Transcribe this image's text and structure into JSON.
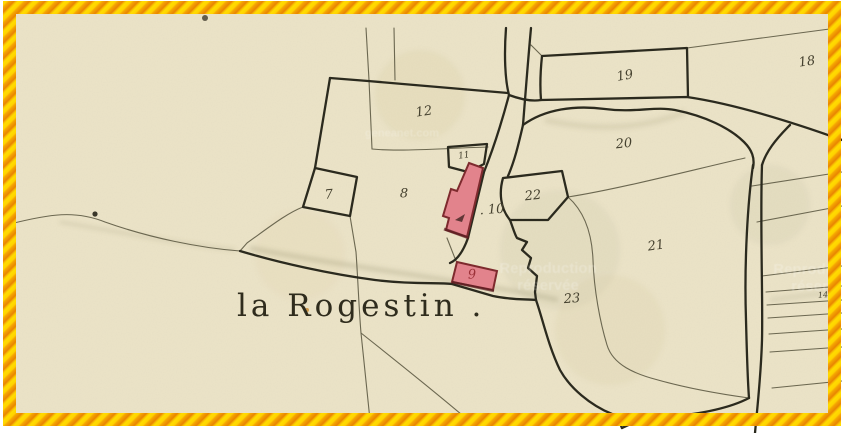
{
  "map": {
    "place_label": "la Rogestin .",
    "parcel_numbers": [
      {
        "id": "7",
        "text": "7",
        "x": 329,
        "y": 195,
        "rot": -5
      },
      {
        "id": "8",
        "text": "8",
        "x": 404,
        "y": 194,
        "rot": 0
      },
      {
        "id": "11",
        "text": "11",
        "x": 464,
        "y": 156,
        "size": 9,
        "rot": -8
      },
      {
        "id": "12",
        "text": "12",
        "x": 424,
        "y": 112,
        "rot": -8
      },
      {
        "id": "10",
        "text": ". 10",
        "x": 492,
        "y": 210,
        "rot": -4
      },
      {
        "id": "9",
        "text": "9",
        "x": 472,
        "y": 275,
        "color": "#9c3138",
        "rot": -2
      },
      {
        "id": "19",
        "text": "19",
        "x": 625,
        "y": 76,
        "rot": -10
      },
      {
        "id": "18",
        "text": "18",
        "x": 807,
        "y": 62,
        "rot": -8
      },
      {
        "id": "20",
        "text": "20",
        "x": 624,
        "y": 144,
        "rot": -6
      },
      {
        "id": "22",
        "text": "22",
        "x": 533,
        "y": 196,
        "rot": -6
      },
      {
        "id": "21",
        "text": "21",
        "x": 656,
        "y": 246,
        "rot": -8
      },
      {
        "id": "23",
        "text": "23",
        "x": 572,
        "y": 299,
        "rot": -4
      },
      {
        "id": "14",
        "text": "14",
        "x": 823,
        "y": 295,
        "size": 8,
        "rot": -5
      }
    ],
    "watermarks": [
      {
        "text": "geneanet.com",
        "x": 402,
        "y": 134,
        "style": "small"
      },
      {
        "text": "Reproduction réservée",
        "x": 548,
        "y": 277,
        "style": "big"
      },
      {
        "text": "Reproduction réservée",
        "x": 822,
        "y": 278,
        "style": "big"
      }
    ],
    "colors": {
      "paper": "#ece4c8",
      "ink_thick": "#2b2a1e",
      "ink_thin": "#6b6750",
      "building_fill": "#e2838c",
      "building_outline": "#7e2a2e",
      "building_number": "#9c3138",
      "ribbon_yellow": "#ffd200",
      "ribbon_orange": "#e98402"
    }
  }
}
